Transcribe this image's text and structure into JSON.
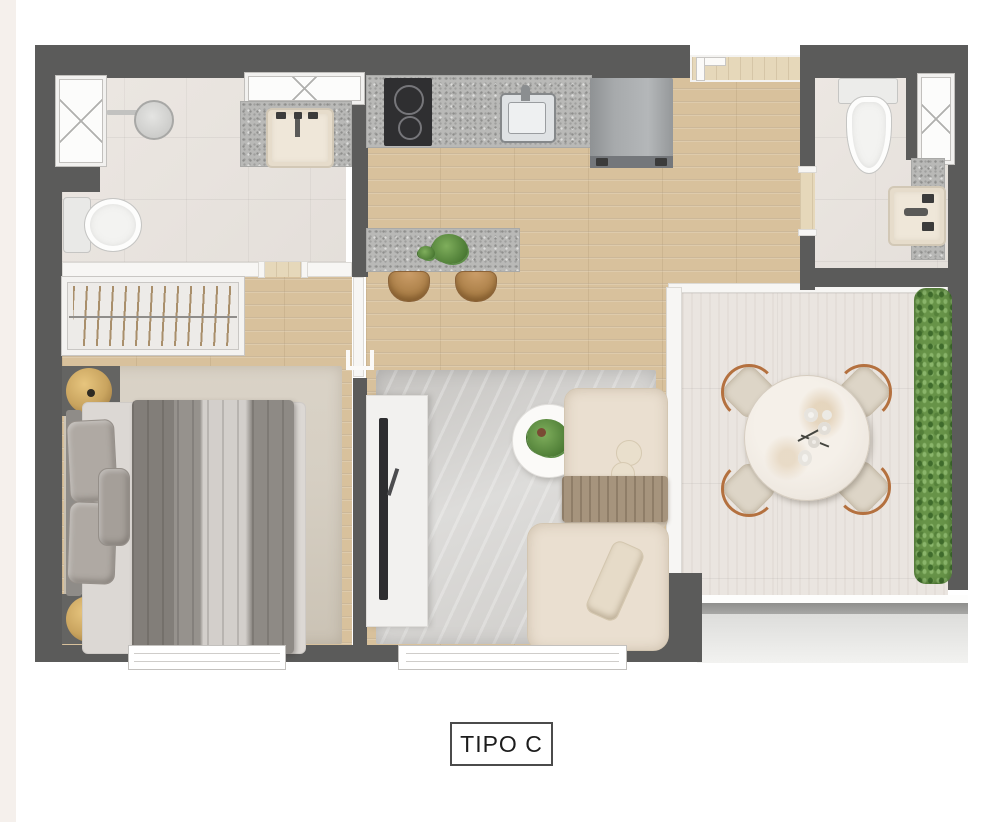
{
  "title": {
    "label": "TIPO C"
  },
  "palette": {
    "wall": "#5b5b5a",
    "interior_wall": "#f7f6f4",
    "wood_floor": "#d8c19c",
    "bath_tile": "#e8e3de",
    "balcony_tile": "#eae5e0",
    "granite": "#b9b9b7",
    "appliance": "#a7aaac",
    "cooktop": "#2f2f31",
    "rug_living": "#d0cecb",
    "rug_bedroom": "#d6cfc3",
    "sofa": "#eadfd0",
    "throw_blanket": "#a6947d",
    "duvet": "#94908b",
    "bed_sheet": "#d3cfcb",
    "marble_table": "#efe9e1",
    "chair_wood": "#b4713f",
    "greenery": "#679348",
    "lamp_gold": "#c9a45f",
    "label_border": "#4b4b4b",
    "label_text": "#1c1c1c"
  }
}
